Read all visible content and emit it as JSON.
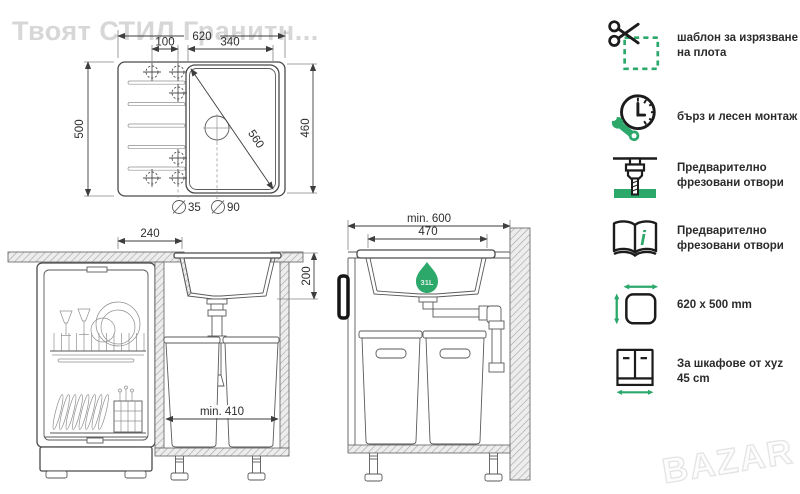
{
  "watermarks": {
    "top_left": "Твоят СТИЛ Гранитн...",
    "bottom_right": "BAZAR"
  },
  "colors": {
    "accent": "#2CA86B",
    "line": "#3E3E3E"
  },
  "top_view": {
    "width": "620",
    "tap_spacing": "100",
    "bowl_width": "340",
    "depth": "500",
    "bowl_depth": "460",
    "bowl_diagonal": "560",
    "tap_hole_dia": "35",
    "drain_hole_dia": "90"
  },
  "front_section": {
    "drainer_offset": "240",
    "bowl_height": "200",
    "min_inner_width": "min. 410"
  },
  "side_section": {
    "min_cabinet": "min. 600",
    "bowl_width": "470",
    "bowl_volume": "31L"
  },
  "features": [
    {
      "icon": "scissors-template-icon",
      "text": "шаблон за изрязване на плота"
    },
    {
      "icon": "clock-wrench-icon",
      "text": "бърз и лесен монтаж"
    },
    {
      "icon": "router-bit-icon",
      "text": "Предварително фрезовани отвори"
    },
    {
      "icon": "manual-book-icon",
      "text": "Предварително фрезовани отвори",
      "letter": "i"
    },
    {
      "icon": "dimensions-icon",
      "text": "620 x 500 mm"
    },
    {
      "icon": "cabinet-size-icon",
      "text": "За шкафове от xyz 45 cm"
    }
  ]
}
